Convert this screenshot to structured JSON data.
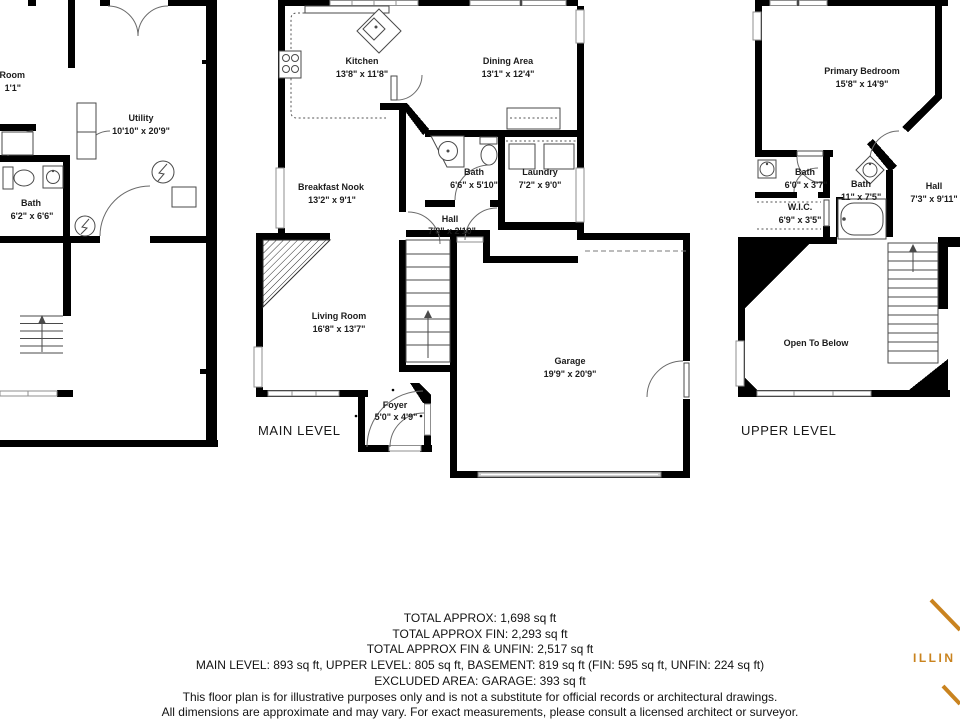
{
  "plans": {
    "basement": {
      "rooms": {
        "cut_room": {
          "name": "Room",
          "dims": "1'1\""
        },
        "utility": {
          "name": "Utility",
          "dims": "10'10\" x 20'9\""
        },
        "bath": {
          "name": "Bath",
          "dims": "6'2\" x 6'6\""
        }
      }
    },
    "main": {
      "title": "MAIN LEVEL",
      "rooms": {
        "kitchen": {
          "name": "Kitchen",
          "dims": "13'8\" x 11'8\""
        },
        "dining": {
          "name": "Dining Area",
          "dims": "13'1\" x 12'4\""
        },
        "breakfast_nook": {
          "name": "Breakfast Nook",
          "dims": "13'2\" x 9'1\""
        },
        "bath": {
          "name": "Bath",
          "dims": "6'6\" x 5'10\""
        },
        "laundry": {
          "name": "Laundry",
          "dims": "7'2\" x 9'0\""
        },
        "hall": {
          "name": "Hall",
          "dims": "7'8\" x 2'10\""
        },
        "living": {
          "name": "Living Room",
          "dims": "16'8\" x 13'7\""
        },
        "foyer": {
          "name": "Foyer",
          "dims": "5'0\" x 4'9\""
        },
        "garage": {
          "name": "Garage",
          "dims": "19'9\" x 20'9\""
        }
      }
    },
    "upper": {
      "title": "UPPER LEVEL",
      "rooms": {
        "primary_bedroom": {
          "name": "Primary Bedroom",
          "dims": "15'8\" x 14'9\""
        },
        "bath1": {
          "name": "Bath",
          "dims": "6'0\" x 3'7\""
        },
        "wic": {
          "name": "W.I.C.",
          "dims": "6'9\" x 3'5\""
        },
        "bath2": {
          "name": "Bath",
          "dims": "11\" x 7'5\""
        },
        "hall": {
          "name": "Hall",
          "dims": "7'3\" x 9'11\""
        },
        "open_to_below": {
          "name": "Open To Below"
        }
      }
    }
  },
  "summary": {
    "line1": "TOTAL APPROX: 1,698 sq ft",
    "line2": "TOTAL APPROX FIN: 2,293 sq ft",
    "line3": "TOTAL APPROX FIN & UNFIN: 2,517 sq ft",
    "line4": "MAIN LEVEL: 893 sq ft, UPPER LEVEL: 805 sq ft, BASEMENT: 819 sq ft (FIN: 595 sq ft, UNFIN: 224 sq ft)",
    "line5": "EXCLUDED AREA: GARAGE: 393 sq ft"
  },
  "disclaimer": {
    "line1": "This floor plan is for illustrative purposes only and is not a substitute for official records or architectural drawings.",
    "line2": "All dimensions are approximate and may vary. For exact measurements, please consult a licensed architect or surveyor."
  },
  "logo": {
    "text": "ILLIN",
    "color": "#c9831f"
  }
}
